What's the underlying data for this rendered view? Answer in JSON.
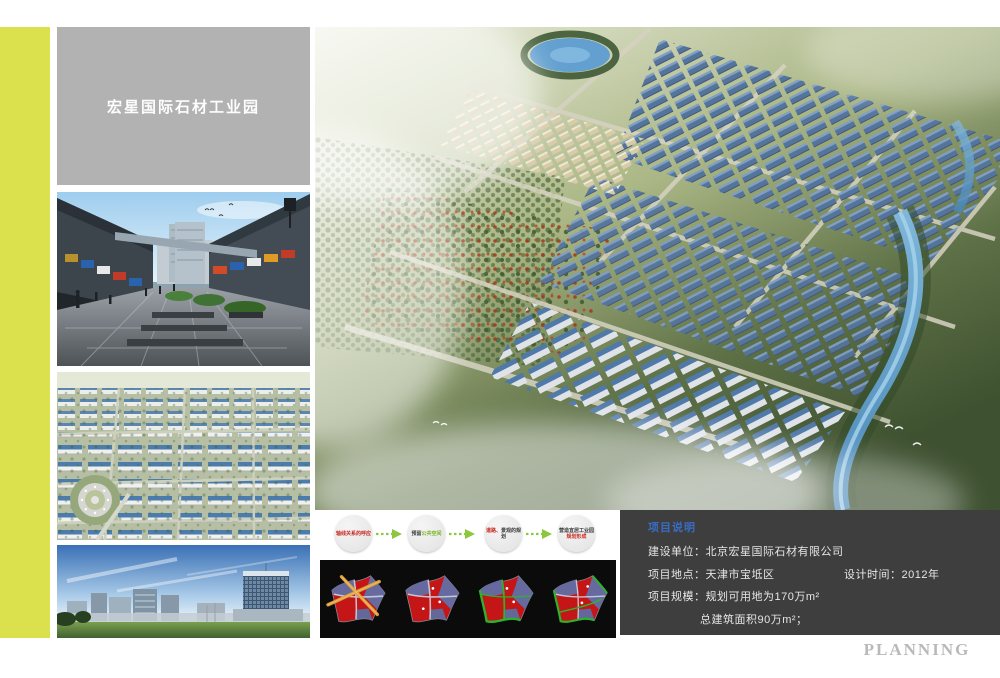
{
  "board": {
    "title": "宏星国际石材工业园",
    "watermark": "PLANNING"
  },
  "flow_diagram": {
    "steps": [
      {
        "line1": "轴线关系的呼应"
      },
      {
        "pre": "预留",
        "line1": "公共空间"
      },
      {
        "pre": "道路、",
        "line1": "景观的规划"
      },
      {
        "line1": "营造宜居工业园",
        "line2": "规划形成"
      }
    ]
  },
  "project_info": {
    "title": "项目说明",
    "rows": [
      {
        "label": "建设单位：",
        "value": "北京宏星国际石材有限公司"
      },
      {
        "label": "项目地点：",
        "value": "天津市宝坻区",
        "label2": "设计时间：",
        "value2": "2012年"
      },
      {
        "label": "项目规模：",
        "value": "规划可用地为170万m²"
      },
      {
        "label": "",
        "value": "总建筑面积90万m²；"
      }
    ]
  },
  "colors": {
    "accent_strip": "#dbe14c",
    "title_box_bg": "#b2b2b2",
    "info_box_bg": "#3e3e3e",
    "info_title_blue": "#3a6cc3",
    "flow_arrow_green": "#8dc63f",
    "flow_text_red": "#c8281e",
    "panel_bg": "#0b0b0b",
    "watermark_gray": "#b9b9b9"
  }
}
